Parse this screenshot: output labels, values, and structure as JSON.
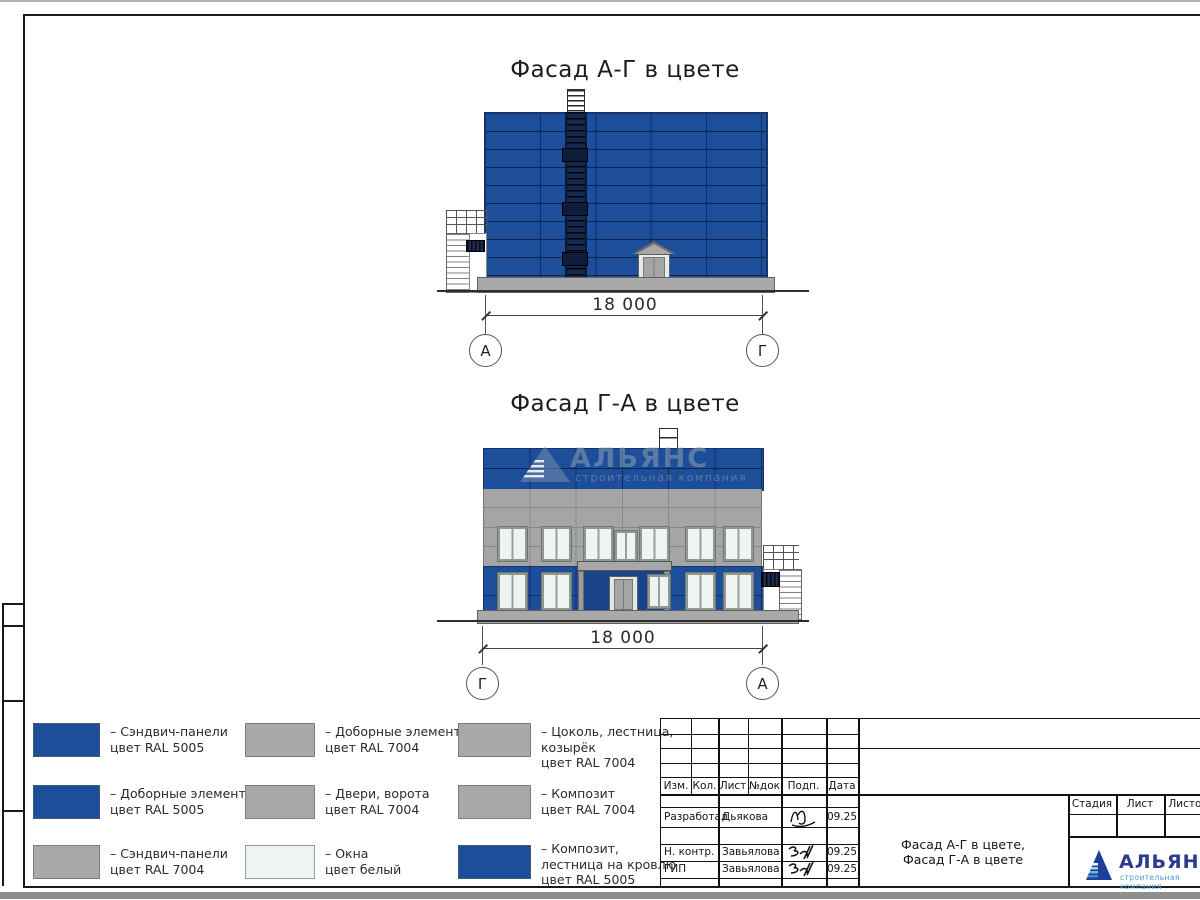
{
  "sheet": {
    "facades": {
      "f1": {
        "title": "Фасад А-Г в цвете",
        "dimension": "18 000",
        "axis_left": "А",
        "axis_right": "Г"
      },
      "f2": {
        "title": "Фасад Г-А в цвете",
        "dimension": "18 000",
        "axis_left": "Г",
        "axis_right": "А"
      }
    },
    "watermark": {
      "name": "АЛЬЯНС",
      "subtitle": "строительная компания"
    },
    "legend": {
      "items": [
        {
          "color": "#1d4e99",
          "lines": [
            "– Сэндвич-панели",
            "цвет RAL 5005"
          ]
        },
        {
          "color": "#a9a9a9",
          "lines": [
            "– Доборные элементы",
            "цвет RAL 7004"
          ]
        },
        {
          "color": "#a9a9a9",
          "lines": [
            "– Цоколь, лестница,",
            "козырёк",
            "цвет RAL 7004"
          ]
        },
        {
          "color": "#1d4e99",
          "lines": [
            "– Доборные элементы",
            "цвет RAL 5005"
          ]
        },
        {
          "color": "#a9a9a9",
          "lines": [
            "– Двери, ворота",
            "цвет RAL 7004"
          ]
        },
        {
          "color": "#a9a9a9",
          "lines": [
            "– Композит",
            "цвет RAL 7004"
          ]
        },
        {
          "color": "#a9a9a9",
          "lines": [
            "– Сэндвич-панели",
            "цвет RAL 7004"
          ]
        },
        {
          "color": "#eef4ef",
          "lines": [
            "– Окна",
            "цвет белый"
          ]
        },
        {
          "color": "#1d4e99",
          "lines": [
            "– Композит,",
            "лестница на кровлю",
            "цвет RAL 5005"
          ]
        }
      ]
    },
    "titleblock": {
      "columns": [
        "Изм.",
        "Кол.",
        "Лист",
        "№док",
        "Подп.",
        "Дата"
      ],
      "rows": [
        {
          "role": "Разработал",
          "name": "Дьякова",
          "date": "09.25"
        },
        {
          "role": "Н. контр.",
          "name": "Завьялова",
          "date": "09.25"
        },
        {
          "role": "ГИП",
          "name": "Завьялова",
          "date": "09.25"
        }
      ],
      "stage_cols": [
        "Стадия",
        "Лист",
        "Листов"
      ],
      "doc_title": [
        "Фасад А-Г в цвете,",
        "Фасад Г-А в цвете"
      ],
      "logo": {
        "name": "АЛЬЯНС",
        "subtitle": "строительная компания"
      }
    },
    "colors": {
      "ral5005": "#1d4e99",
      "ral7004": "#a9a9a9",
      "window_white": "#eef4ef",
      "logo_blue": "#2b3990",
      "logo_light": "#4f9bd5"
    }
  }
}
